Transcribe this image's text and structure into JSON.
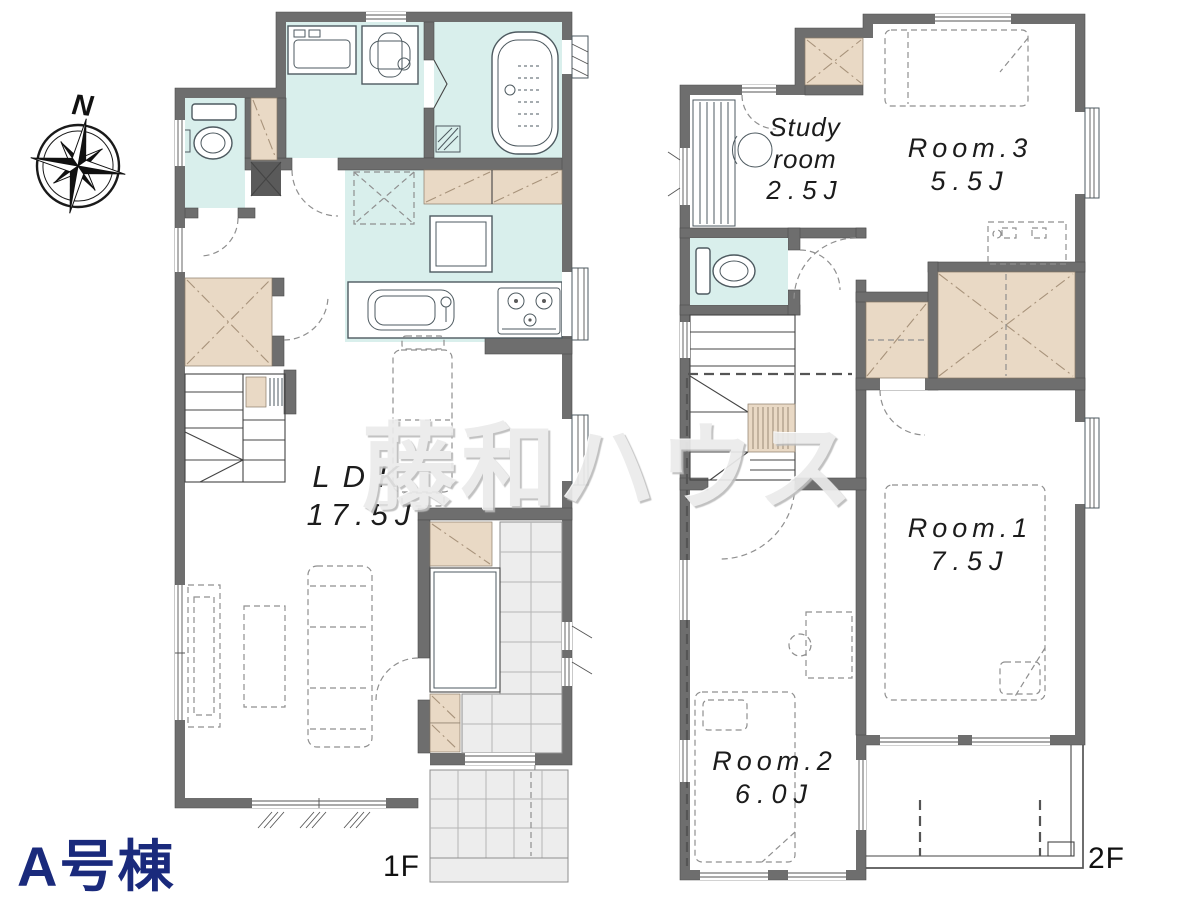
{
  "building": {
    "name": "A号棟"
  },
  "compass": {
    "north_label": "N"
  },
  "watermark": {
    "text": "藤和ハウス"
  },
  "floor_1": {
    "label": "1F",
    "rooms": {
      "ldk": {
        "name": "LDK",
        "size": "17.5J"
      }
    }
  },
  "floor_2": {
    "label": "2F",
    "rooms": {
      "study": {
        "name_line_1": "Study",
        "name_line_2": "room",
        "size": "2.5J"
      },
      "room_3": {
        "name": "Room.3",
        "size": "5.5J"
      },
      "room_1": {
        "name": "Room.1",
        "size": "7.5J"
      },
      "room_2": {
        "name": "Room.2",
        "size": "6.0J"
      }
    }
  },
  "palette": {
    "wall": "#6e6e6e",
    "wet_area": "#d9efec",
    "closet": "#e9d9c5",
    "tile": "#ededed",
    "title_navy": "#1a2a7c",
    "watermark_gray": "#ebebeb"
  }
}
